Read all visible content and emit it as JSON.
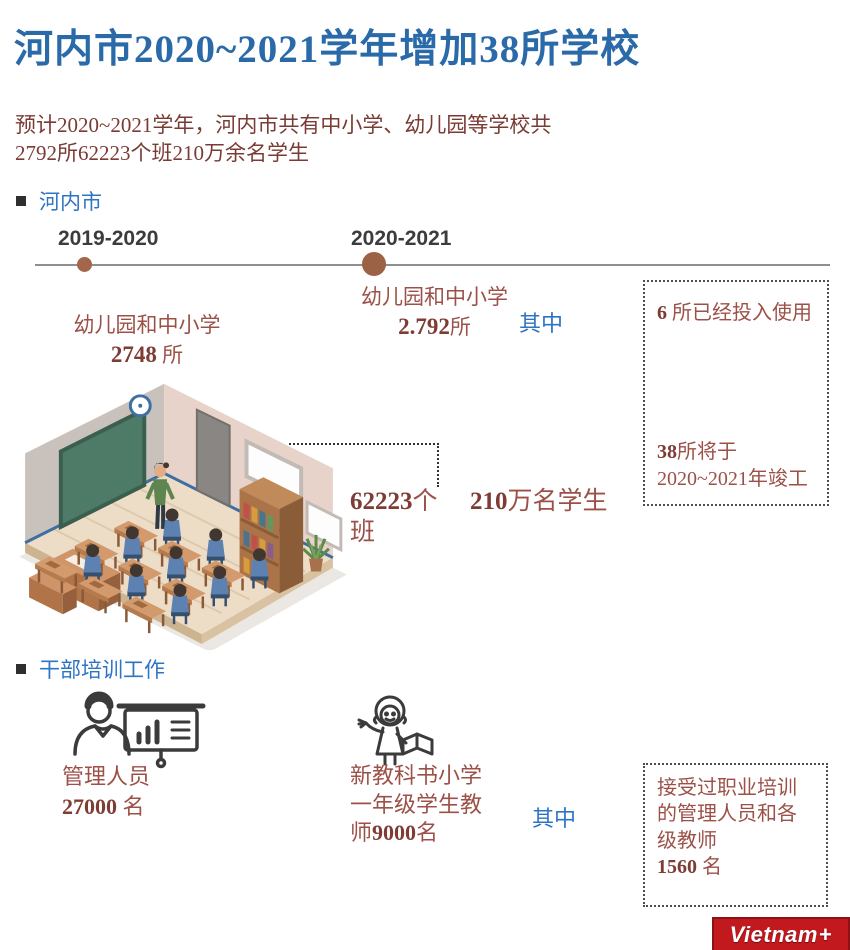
{
  "header": {
    "title": "河内市2020~2021学年增加38所学校",
    "subtitle_line1": "预计2020~2021学年，河内市共有中小学、幼儿园等学校共",
    "subtitle_line2": "2792所62223个班210万余名学生"
  },
  "hanoi_section": {
    "label": "河内市",
    "timeline": {
      "year_left": "2019-2020",
      "year_right": "2020-2021"
    },
    "stat_2019": {
      "line1": "幼儿园和中小学",
      "value": "2748",
      "unit": " 所"
    },
    "stat_2020": {
      "line1": "幼儿园和中小学",
      "value": "2.792",
      "unit": "所"
    },
    "among": "其中",
    "callout": {
      "in_use_value": "6",
      "in_use_text": " 所已经投入使用",
      "planned_value": "38",
      "planned_text": "所将于",
      "planned_line2": "2020~2021年竣工"
    },
    "classes": {
      "value": "62223",
      "unit": "个",
      "unit_line2": "班"
    },
    "students": {
      "value": "210",
      "unit": "万名学生"
    }
  },
  "training_section": {
    "label": "干部培训工作",
    "managers": {
      "label": "管理人员",
      "value": "27000",
      "unit": " 名"
    },
    "teachers": {
      "line1": "新教科书小学",
      "line2": "一年级学生教",
      "line3_prefix": "师",
      "value": "9000",
      "unit": "名"
    },
    "among": "其中",
    "callout": {
      "line1": "接受过职业培训",
      "line2": "的管理人员和各",
      "line3": "级教师",
      "value": "1560",
      "unit": " 名"
    }
  },
  "logo": {
    "name": "Vietnam",
    "plus": "+"
  },
  "colors": {
    "title_blue": "#2b6aa9",
    "accent_blue": "#2e74c4",
    "maroon": "#9c5148",
    "maroon_dark": "#7e3c35",
    "timeline_dot": "#a2674a",
    "logo_red": "#c2191e"
  }
}
